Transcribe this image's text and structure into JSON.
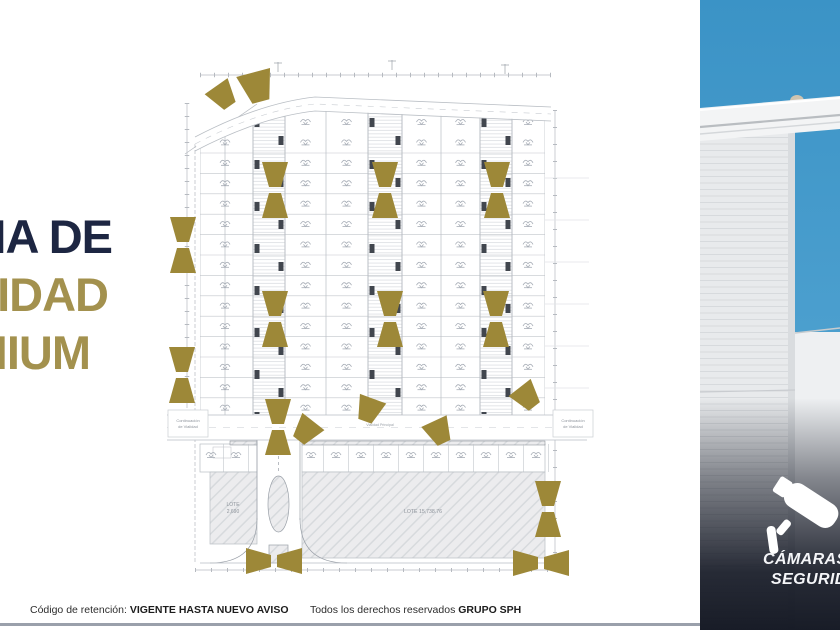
{
  "slide": {
    "title": {
      "line1": "SISTEMA DE",
      "line2": "SEGURIDAD",
      "line3": "PREMIUM",
      "primary_color": "#1d2642",
      "accent_color": "#a3914e"
    },
    "footer": {
      "left_label": "Código de retención: ",
      "left_value": "VIGENTE  HASTA NUEVO AVISO",
      "right_label": "Todos los derechos reservados ",
      "right_value": "GRUPO SPH"
    }
  },
  "site_plan": {
    "lot_left_line1": "LOTE",
    "lot_left_line2": "2,690",
    "lot_right": "LOTE 15,738.76",
    "road_left_line1": "Continuación",
    "road_left_line2": "de Vialidad",
    "road_right_line1": "Continuación",
    "road_right_line2": "de Vialidad",
    "road_center": "Vialidad Principal",
    "camera_marker_color": "#9d8838"
  },
  "photo_overlay": {
    "badge_line1": "CÁMARAS DE",
    "badge_line2": "SEGURIDAD",
    "sky_color": "#3f98c9",
    "badge_bg": "#161a26"
  }
}
